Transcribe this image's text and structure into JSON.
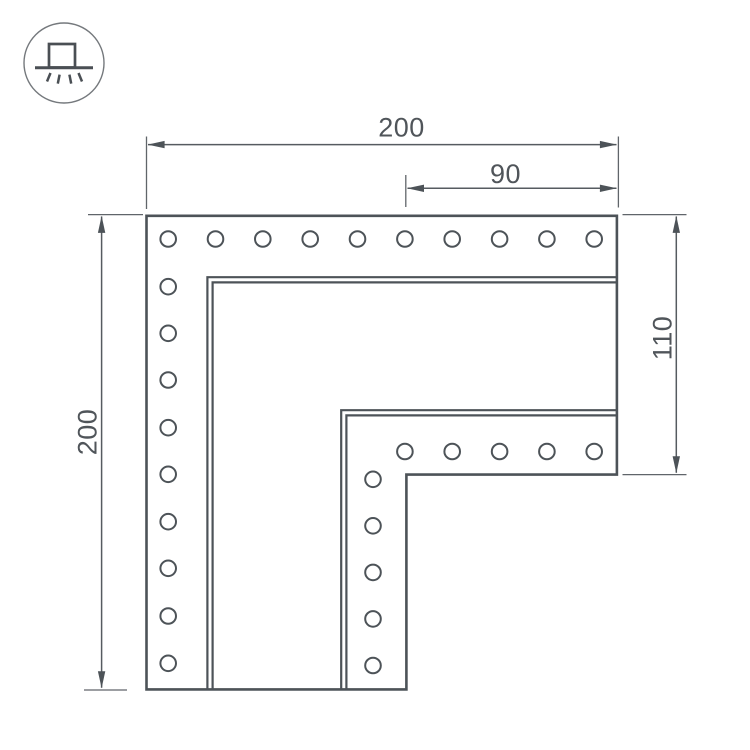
{
  "icon": {
    "name": "surface-mounted-light-icon",
    "description": "luminaire box on ceiling line with downward light rays inside a circle"
  },
  "drawing": {
    "type": "technical-dimension-drawing",
    "part": "L-shaped corner connector plate with screw holes",
    "colors": {
      "part_line": "#4d5358",
      "dimension_line": "#565b60",
      "text": "#50555a",
      "background": "#ffffff"
    },
    "dimensions": [
      {
        "id": "overall-width",
        "label": "200"
      },
      {
        "id": "right-arm-offset",
        "label": "90"
      },
      {
        "id": "overall-height",
        "label": "200"
      },
      {
        "id": "right-arm-height",
        "label": "110"
      }
    ],
    "holes": {
      "radius": 7.8,
      "top_row": {
        "y": 239,
        "x": [
          168.2,
          215.5,
          262.8,
          310.2,
          357.5,
          404.9,
          452.2,
          499.6,
          546.9,
          594.2
        ]
      },
      "left_col": {
        "x": 168.2,
        "y": [
          286.7,
          333.3,
          380.0,
          427.7,
          474.3,
          521.7,
          568.3,
          616.0,
          663.3
        ]
      },
      "inner_row": {
        "y": 451.5,
        "x": [
          404.9,
          452.2,
          499.6,
          546.9,
          594.2
        ]
      },
      "inner_col": {
        "x": 373,
        "y": [
          479.3,
          525.8,
          572.4,
          618.9,
          665.5
        ]
      }
    }
  }
}
